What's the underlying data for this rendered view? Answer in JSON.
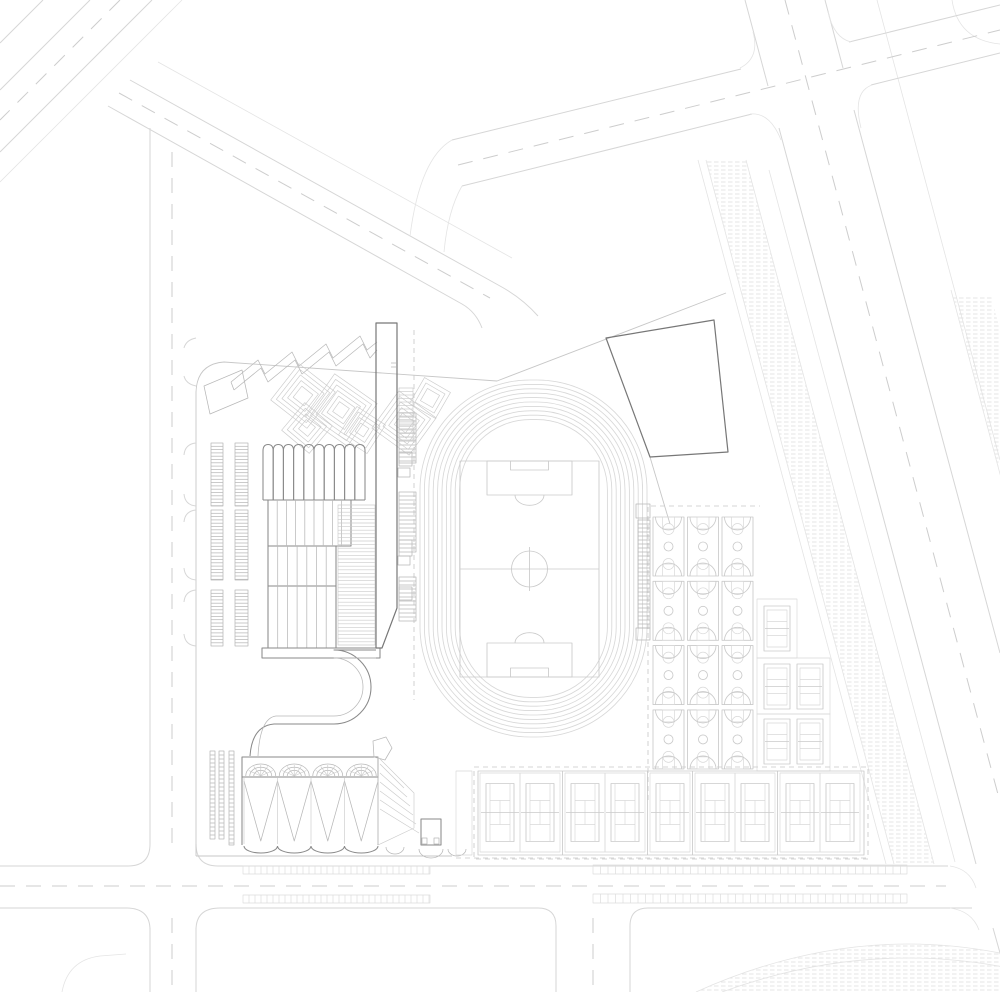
{
  "document": {
    "type": "architectural-site-plan",
    "content": "school campus master plan, line drawing, no text labels"
  },
  "palette": {
    "paper": "#ffffff",
    "road": "#d6d6d6",
    "road_dash": "#cdcdcd",
    "parcel": "#e4e4e4",
    "fence": "#c7c7c7",
    "building": "#8a8a8a",
    "building_dark": "#777777",
    "detail": "#b8b8b8",
    "court": "#cacaca",
    "court_faint": "#d9d9d9",
    "track": "#d8d8d8",
    "terrace": "#cbcbcb",
    "hatch_line": "#dddddd"
  },
  "facilities": {
    "running_track": {
      "name": "running-track",
      "lanes": 10
    },
    "soccer_field": {
      "name": "soccer-field"
    },
    "basketball": {
      "name": "basketball-courts",
      "count": 12,
      "columns": 3,
      "rows": 4
    },
    "volleyball": {
      "name": "volleyball-courts",
      "count": 5
    },
    "tennis": {
      "name": "tennis-courts",
      "count": 9,
      "groups": [
        2,
        2,
        1,
        2,
        2
      ]
    },
    "parking": {
      "name": "parking-rows",
      "groups": 3,
      "columns_per_group": 2
    },
    "gym": {
      "name": "gymnasium",
      "roof_folds": 4,
      "entrance_arches": 4
    },
    "teaching_building": {
      "name": "teaching-building",
      "roof_bays": 10
    },
    "canopy": {
      "name": "zigzag-canopy",
      "teeth": 4
    }
  }
}
